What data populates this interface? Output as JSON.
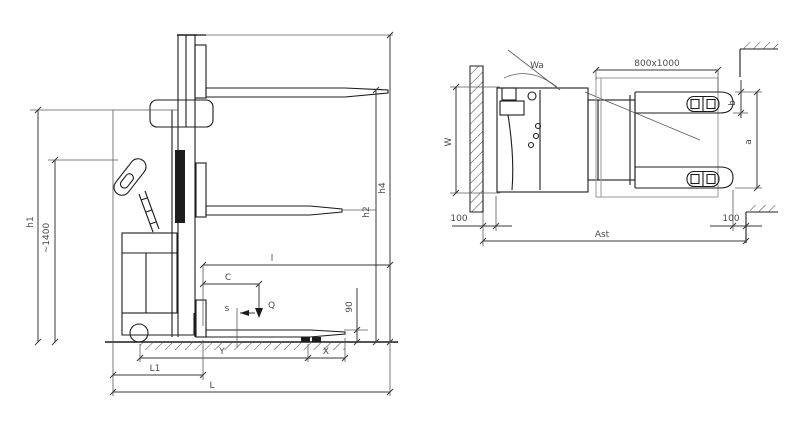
{
  "drawing_title": "pallet-stacker-dimension-drawing",
  "colors": {
    "line": "#1c1c1c",
    "dimension": "#3a3a3a",
    "label": "#4a4a4a",
    "pallet": "#9a9a9a",
    "background": "#ffffff"
  },
  "side": {
    "h1": "h1",
    "tiller_height": "~1400",
    "h4": "h4",
    "h2": "h2",
    "lowered_fork_height": "90",
    "fork_length": "l",
    "load_center": "C",
    "load": "Q",
    "fork_thickness": "s",
    "wheelbase": "Y",
    "load_distance": "X",
    "length_to_forks": "L1",
    "overall_length": "L"
  },
  "top": {
    "overall_width": "W",
    "turning_radius": "Wa",
    "pallet_size": "800x1000",
    "fork_width": "b",
    "fork_spread": "a",
    "clearance_rear": "100",
    "clearance_front": "100",
    "aisle_width": "Ast"
  }
}
